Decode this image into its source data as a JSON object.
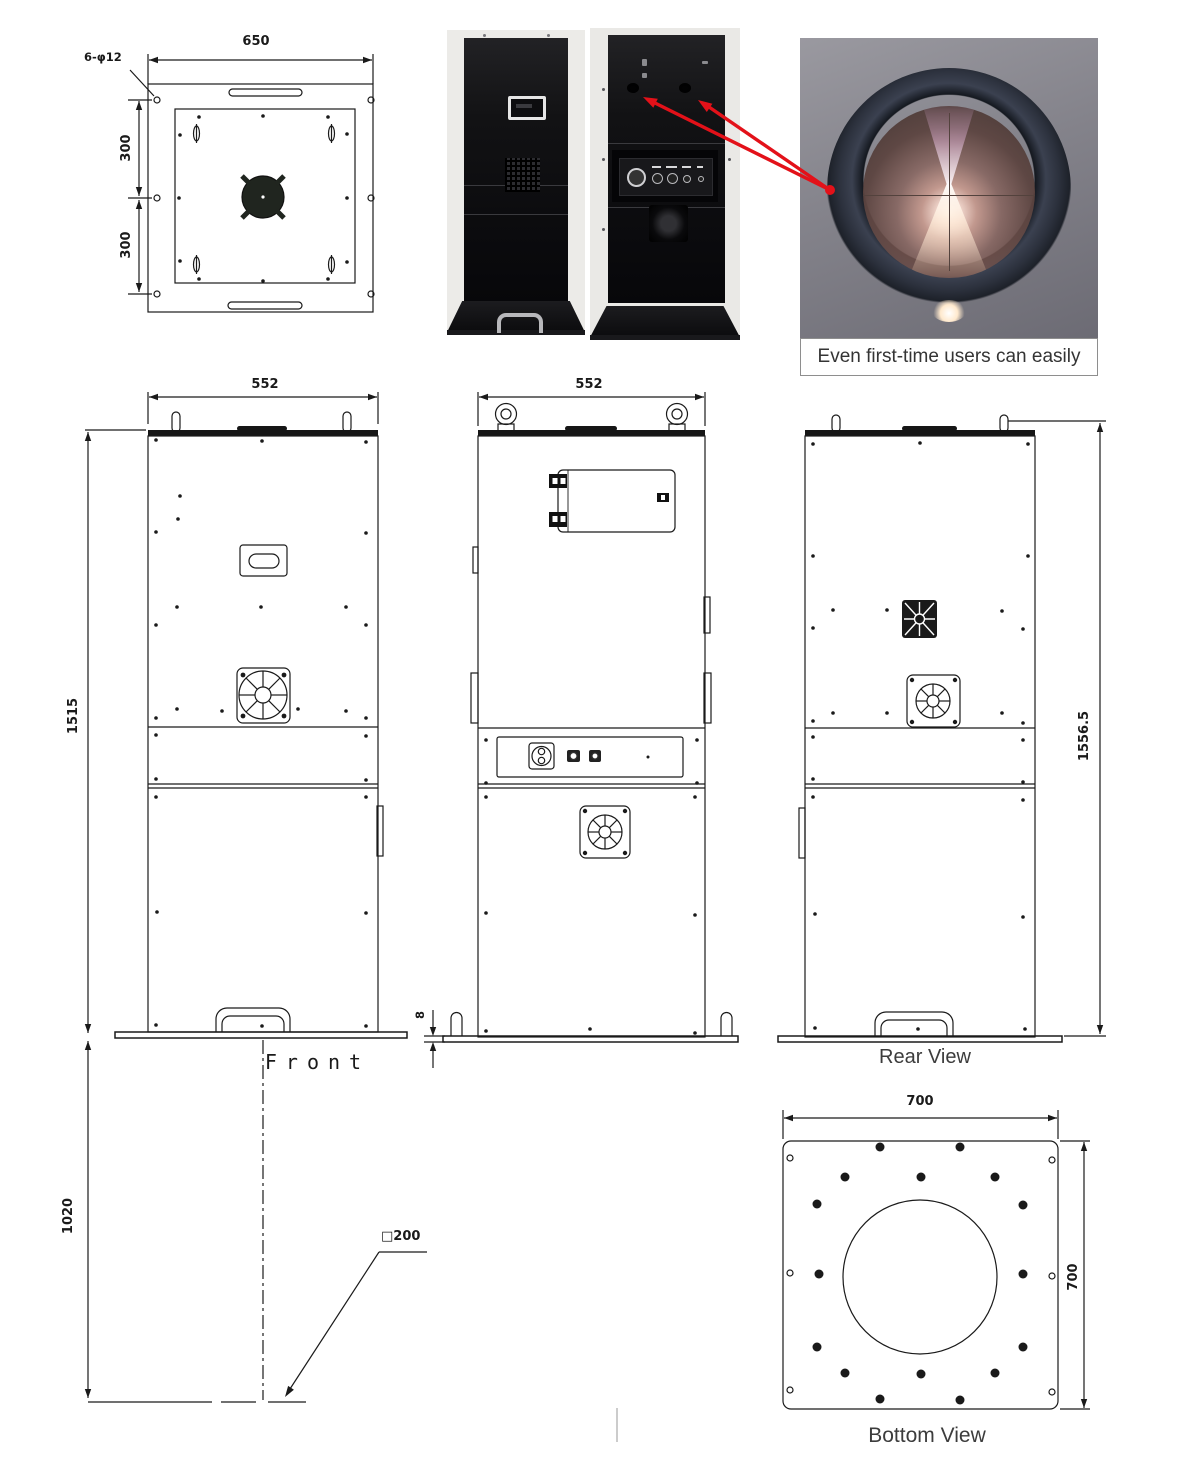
{
  "colors": {
    "line": "#1a1a1a",
    "arrow_red": "#e31119"
  },
  "top_view": {
    "width_dim": "650",
    "holes_callout": "6-φ12",
    "upper_height_dim": "300",
    "lower_height_dim": "300"
  },
  "photos": {
    "lens_caption": "Even first-time users can easily"
  },
  "front_view": {
    "width_dim": "552",
    "height_dim": "1515",
    "label": "Front",
    "ground_clearance_dim": "1020",
    "square_callout": "□200"
  },
  "center_view": {
    "width_dim": "552",
    "base_thickness_dim": "8"
  },
  "rear_view": {
    "height_dim": "1556.5",
    "label": "Rear View"
  },
  "bottom_view": {
    "width_dim": "700",
    "height_dim": "700",
    "label": "Bottom View"
  }
}
